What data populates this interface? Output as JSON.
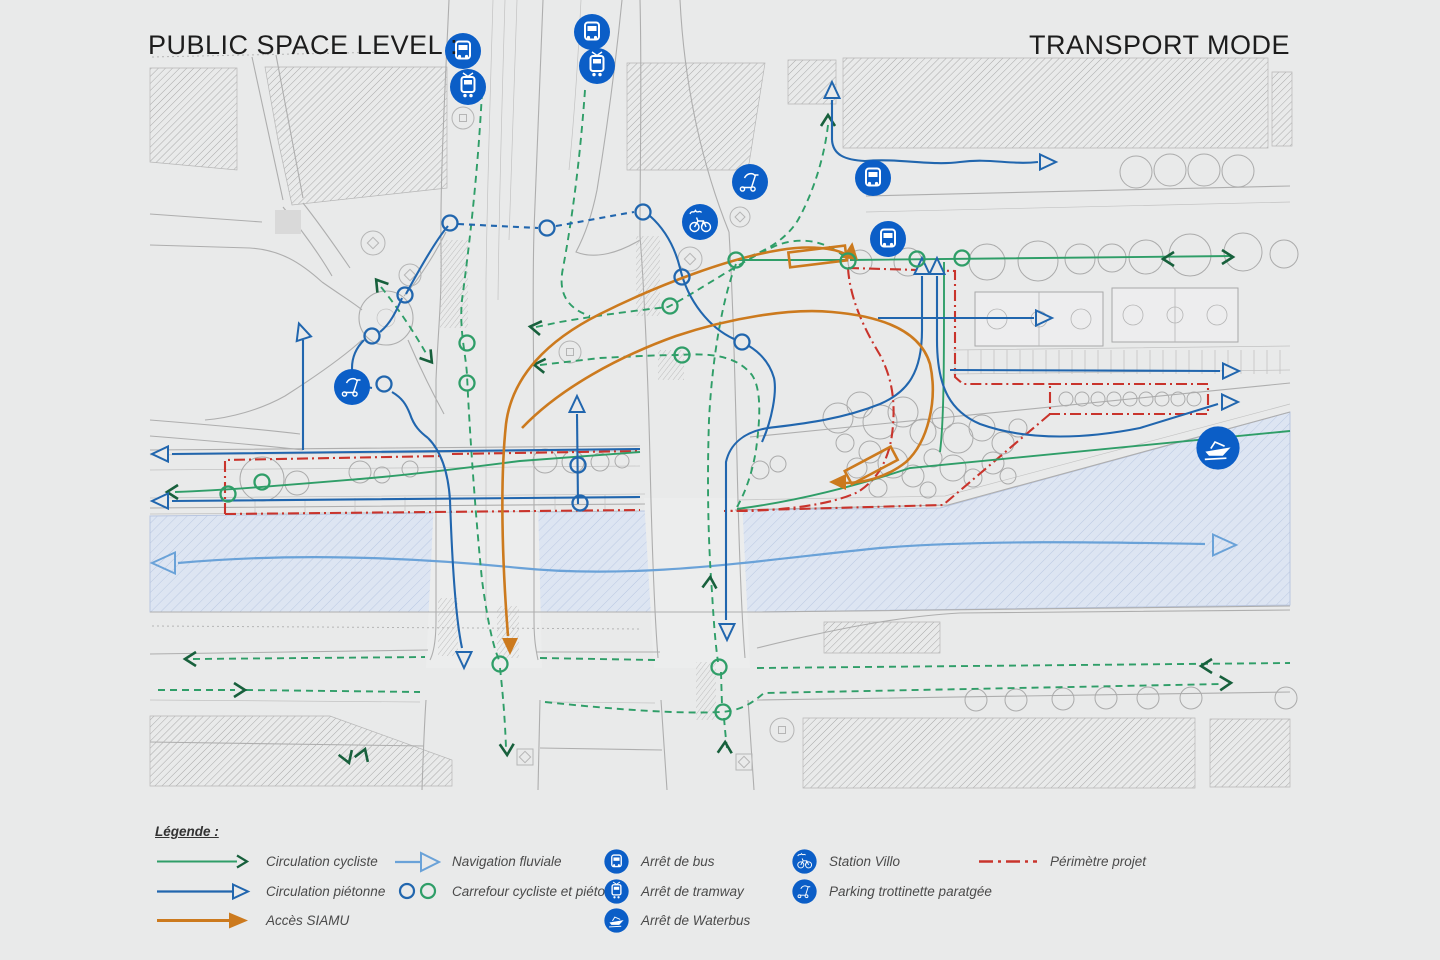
{
  "header": {
    "title_left": "PUBLIC SPACE LEVEL :",
    "title_right": "TRANSPORT MODE"
  },
  "legend": {
    "heading": "Légende :",
    "items": [
      {
        "id": "cyclist",
        "symbol": "green-arrow",
        "label": "Circulation cycliste"
      },
      {
        "id": "pedestrian",
        "symbol": "blue-arrow",
        "label": "Circulation piétonne"
      },
      {
        "id": "siamu",
        "symbol": "orange-arrow",
        "label": "Accès SIAMU"
      },
      {
        "id": "navigation",
        "symbol": "lightblue-arrow",
        "label": "Navigation fluviale"
      },
      {
        "id": "crossing",
        "symbol": "blue-green-circles",
        "label": "Carrefour cycliste et piéton"
      },
      {
        "id": "bus",
        "symbol": "bus-icon",
        "label": "Arrêt de bus"
      },
      {
        "id": "tram",
        "symbol": "tram-icon",
        "label": "Arrêt de tramway"
      },
      {
        "id": "waterbus",
        "symbol": "waterbus-icon",
        "label": "Arrêt de Waterbus"
      },
      {
        "id": "villo",
        "symbol": "villo-icon",
        "label": "Station Villo"
      },
      {
        "id": "scooter",
        "symbol": "scooter-icon",
        "label": "Parking trottinette paratgée"
      },
      {
        "id": "perimeter",
        "symbol": "red-dashdot-line",
        "label": "Périmètre projet"
      }
    ]
  },
  "map_markers": [
    "bus",
    "tram",
    "bus",
    "tram",
    "parking-trottinette",
    "station-villo",
    "bus",
    "bus",
    "parking-trottinette",
    "waterbus"
  ],
  "colors": {
    "background": "#e9eaea",
    "cyclist_green": "#2f9e68",
    "cyclist_green_dark": "#17603c",
    "pedestrian_blue": "#2166ae",
    "navigation_blue": "#6aa2d8",
    "siamu_orange": "#cc7a1e",
    "perimeter_red": "#c9342c",
    "icon_blue": "#0b5ec7",
    "water_fill": "#dde5f2",
    "line_gray": "#b0b0b0"
  }
}
